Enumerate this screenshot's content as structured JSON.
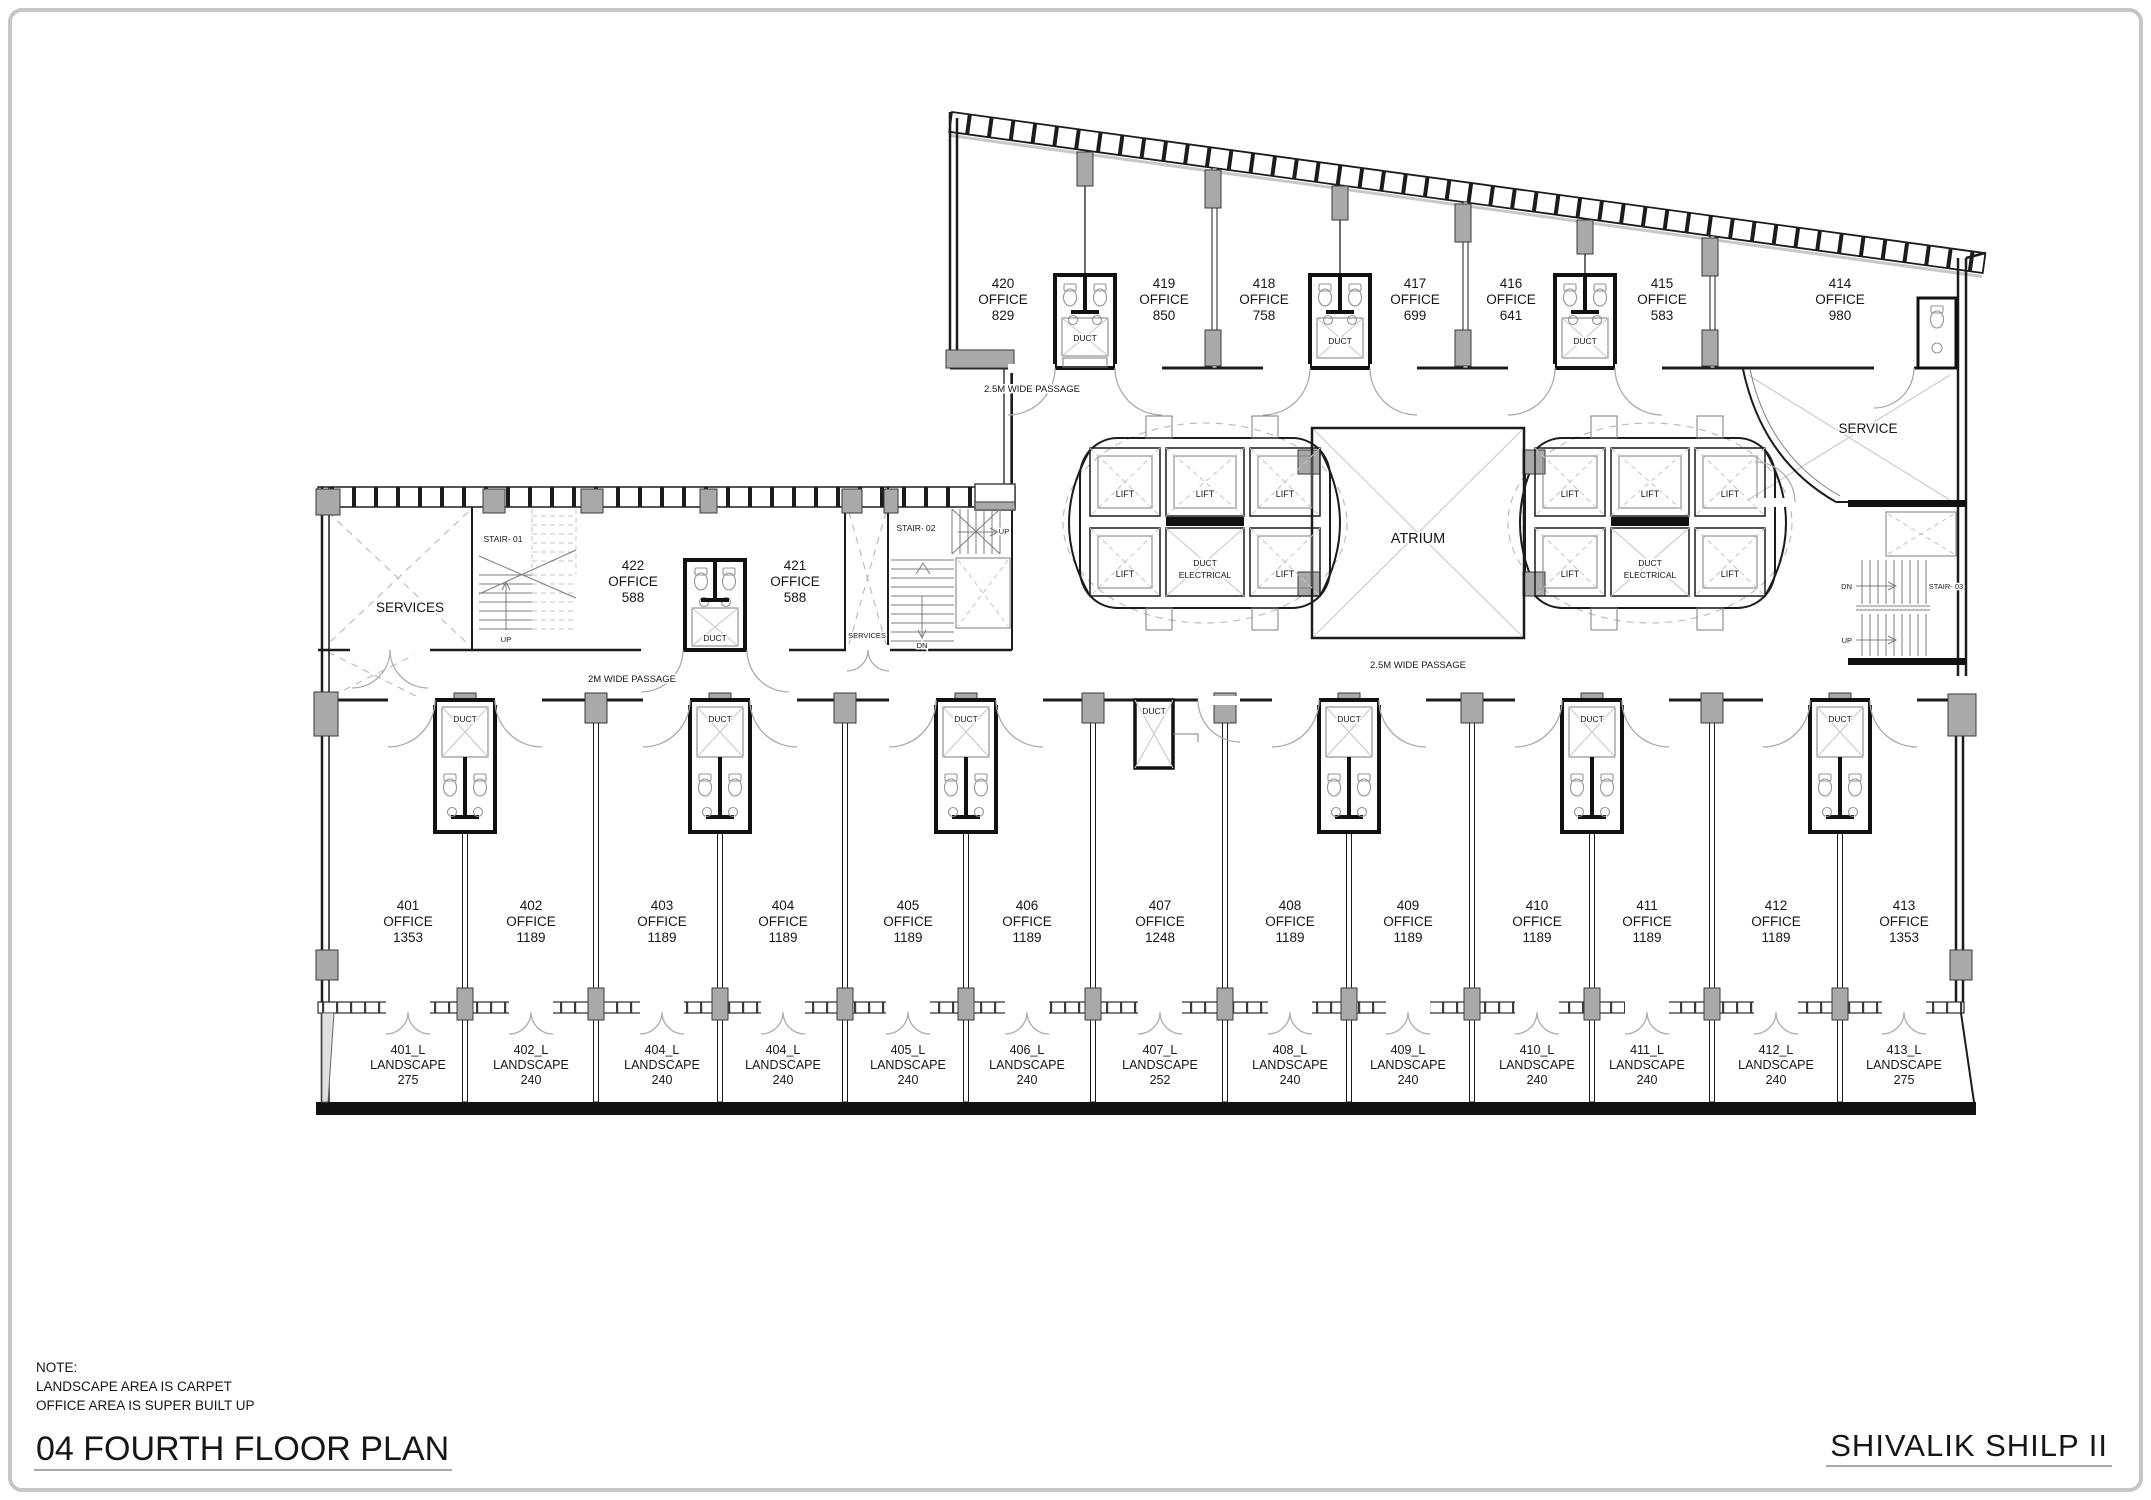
{
  "drawing": {
    "note_heading": "NOTE:",
    "note_line1": "LANDSCAPE AREA IS CARPET",
    "note_line2": "OFFICE AREA IS SUPER BUILT UP",
    "plan_title": "04 FOURTH FLOOR PLAN",
    "project_title": "SHIVALIK SHILP  II"
  },
  "labels": {
    "office": "OFFICE",
    "landscape": "LANDSCAPE",
    "duct": "DUCT",
    "lift": "LIFT",
    "atrium": "ATRIUM",
    "service": "SERVICE",
    "services": "SERVICES",
    "duct_electrical_line1": "DUCT",
    "duct_electrical_line2": "ELECTRICAL",
    "up": "UP",
    "dn": "DN",
    "stair_01": "STAIR- 01",
    "stair_02": "STAIR- 02",
    "stair_03": "STAIR- 03",
    "passage_wide_25": "2.5M WIDE PASSAGE",
    "passage_wide_2": "2M WIDE PASSAGE"
  },
  "top_offices": [
    {
      "number": "420",
      "area": 829
    },
    {
      "number": "419",
      "area": 850
    },
    {
      "number": "418",
      "area": 758
    },
    {
      "number": "417",
      "area": 699
    },
    {
      "number": "416",
      "area": 641
    },
    {
      "number": "415",
      "area": 583
    },
    {
      "number": "414",
      "area": 980
    }
  ],
  "mid_offices": [
    {
      "number": "422",
      "area": 588
    },
    {
      "number": "421",
      "area": 588
    }
  ],
  "bottom_offices": [
    {
      "number": "401",
      "area": 1353
    },
    {
      "number": "402",
      "area": 1189
    },
    {
      "number": "403",
      "area": 1189
    },
    {
      "number": "404",
      "area": 1189
    },
    {
      "number": "405",
      "area": 1189
    },
    {
      "number": "406",
      "area": 1189
    },
    {
      "number": "407",
      "area": 1248
    },
    {
      "number": "408",
      "area": 1189
    },
    {
      "number": "409",
      "area": 1189
    },
    {
      "number": "410",
      "area": 1189
    },
    {
      "number": "411",
      "area": 1189
    },
    {
      "number": "412",
      "area": 1189
    },
    {
      "number": "413",
      "area": 1353
    }
  ],
  "landscape_units": [
    {
      "number": "401_L",
      "area": 275
    },
    {
      "number": "402_L",
      "area": 240
    },
    {
      "number": "404_L",
      "area": 240
    },
    {
      "number": "404_L",
      "area": 240
    },
    {
      "number": "405_L",
      "area": 240
    },
    {
      "number": "406_L",
      "area": 240
    },
    {
      "number": "407_L",
      "area": 252
    },
    {
      "number": "408_L",
      "area": 240
    },
    {
      "number": "409_L",
      "area": 240
    },
    {
      "number": "410_L",
      "area": 240
    },
    {
      "number": "411_L",
      "area": 240
    },
    {
      "number": "412_L",
      "area": 240
    },
    {
      "number": "413_L",
      "area": 275
    }
  ],
  "colors": {
    "wall": "#1c1c1c",
    "column": "#a9a9a9",
    "light": "#9c9c9c",
    "border": "#c6c6c6"
  }
}
